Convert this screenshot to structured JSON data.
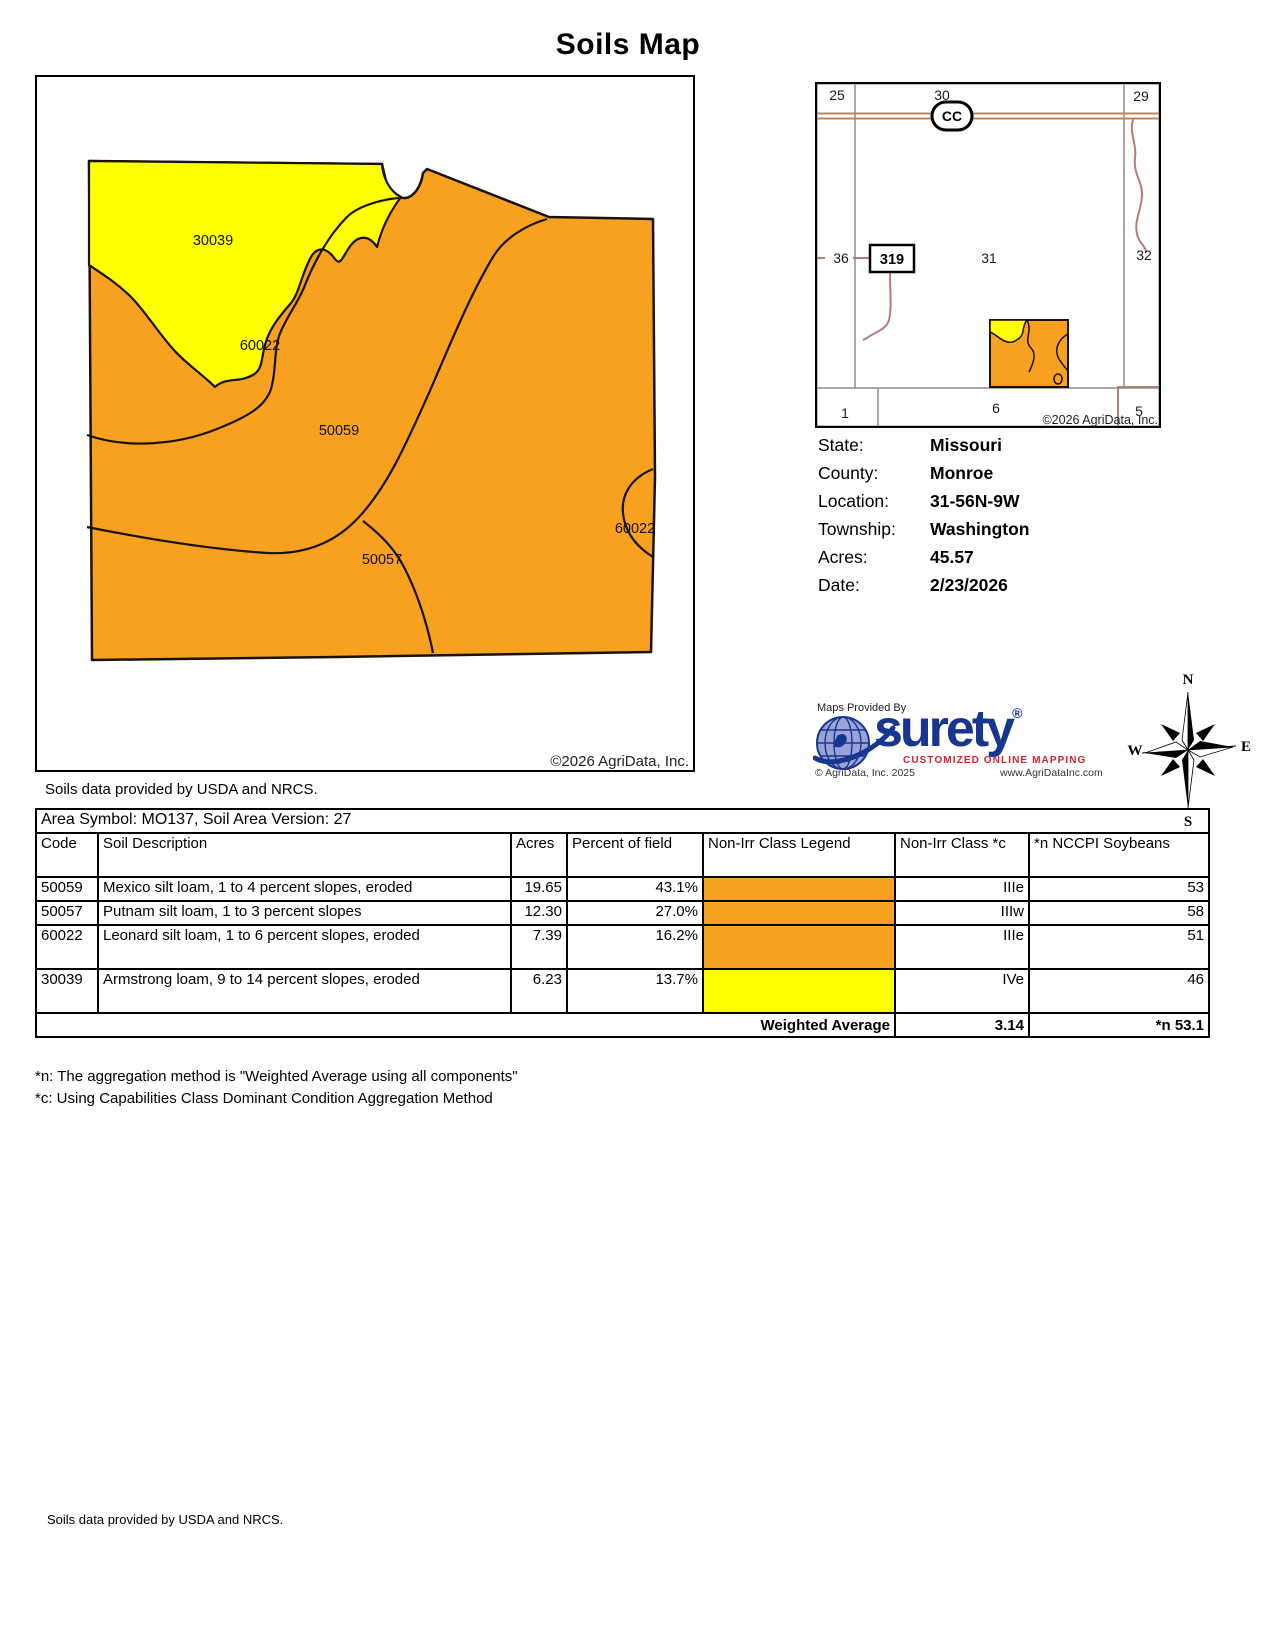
{
  "page": {
    "title": "Soils Map",
    "footer_attribution": "Soils data provided by USDA and NRCS."
  },
  "soil_map": {
    "region_labels": [
      {
        "text": "30039"
      },
      {
        "text": "60022"
      },
      {
        "text": "50059"
      },
      {
        "text": "50057"
      },
      {
        "text": "60022"
      }
    ],
    "copyright": "©2026 AgriData, Inc.",
    "attribution": "Soils data provided by USDA and NRCS."
  },
  "plat_map": {
    "sections": {
      "s25": "25",
      "s30": "30",
      "s29": "29",
      "s36": "36",
      "s31": "31",
      "s32": "32",
      "s1": "1",
      "s6": "6",
      "s5": "5"
    },
    "highway_sign": "CC",
    "road_sign": "319",
    "copyright": "©2026 AgriData, Inc."
  },
  "field_info": {
    "rows": [
      {
        "label": "State:",
        "value": "Missouri"
      },
      {
        "label": "County:",
        "value": "Monroe"
      },
      {
        "label": "Location:",
        "value": "31-56N-9W"
      },
      {
        "label": "Township:",
        "value": "Washington"
      },
      {
        "label": "Acres:",
        "value": "45.57"
      },
      {
        "label": "Date:",
        "value": "2/23/2026"
      }
    ]
  },
  "logo": {
    "provided_by": "Maps Provided By",
    "name": "surety",
    "registered": "®",
    "tagline": "CUSTOMIZED ONLINE MAPPING",
    "copyright": "© AgriData, Inc. 2025",
    "website": "www.AgriDataInc.com"
  },
  "compass": {
    "north": "N",
    "south": "S",
    "east": "E",
    "west": "W"
  },
  "soil_table": {
    "area_symbol_line": "Area Symbol: MO137, Soil Area Version: 27",
    "columns": {
      "code": "Code",
      "description": "Soil Description",
      "acres": "Acres",
      "percent": "Percent of field",
      "legend": "Non-Irr Class Legend",
      "nonirr_class": "Non-Irr Class *c",
      "nccpi": "*n NCCPI Soybeans"
    },
    "rows": [
      {
        "code": "50059",
        "description": "Mexico silt loam, 1 to 4 percent slopes, eroded",
        "acres": "19.65",
        "percent": "43.1%",
        "legend_color": "#F8A121",
        "nonirr_class": "IIIe",
        "nccpi": "53"
      },
      {
        "code": "50057",
        "description": "Putnam silt loam, 1 to 3 percent slopes",
        "acres": "12.30",
        "percent": "27.0%",
        "legend_color": "#F8A121",
        "nonirr_class": "IIIw",
        "nccpi": "58"
      },
      {
        "code": "60022",
        "description": "Leonard silt loam, 1 to 6 percent slopes, eroded",
        "acres": "7.39",
        "percent": "16.2%",
        "legend_color": "#F8A121",
        "nonirr_class": "IIIe",
        "nccpi": "51"
      },
      {
        "code": "30039",
        "description": "Armstrong loam, 9 to 14 percent slopes, eroded",
        "acres": "6.23",
        "percent": "13.7%",
        "legend_color": "#FEFF00",
        "nonirr_class": "IVe",
        "nccpi": "46"
      }
    ],
    "weighted_average": {
      "label": "Weighted Average",
      "nonirr_class": "3.14",
      "nccpi": "*n 53.1"
    }
  },
  "footnotes": [
    {
      "text": "*n: The aggregation method is \"Weighted Average using all components\""
    },
    {
      "text": "*c: Using Capabilities Class Dominant Condition Aggregation Method"
    }
  ],
  "colors": {
    "soil_orange": "#F8A121",
    "soil_yellow": "#FEFF00",
    "surety_blue": "#17368F",
    "globe_fill": "#9AA3D6",
    "tagline_red": "#C9252C",
    "road_highway": "#B9875F",
    "road_minor": "#B27D7A",
    "section_gray": "#8C8C8C"
  }
}
